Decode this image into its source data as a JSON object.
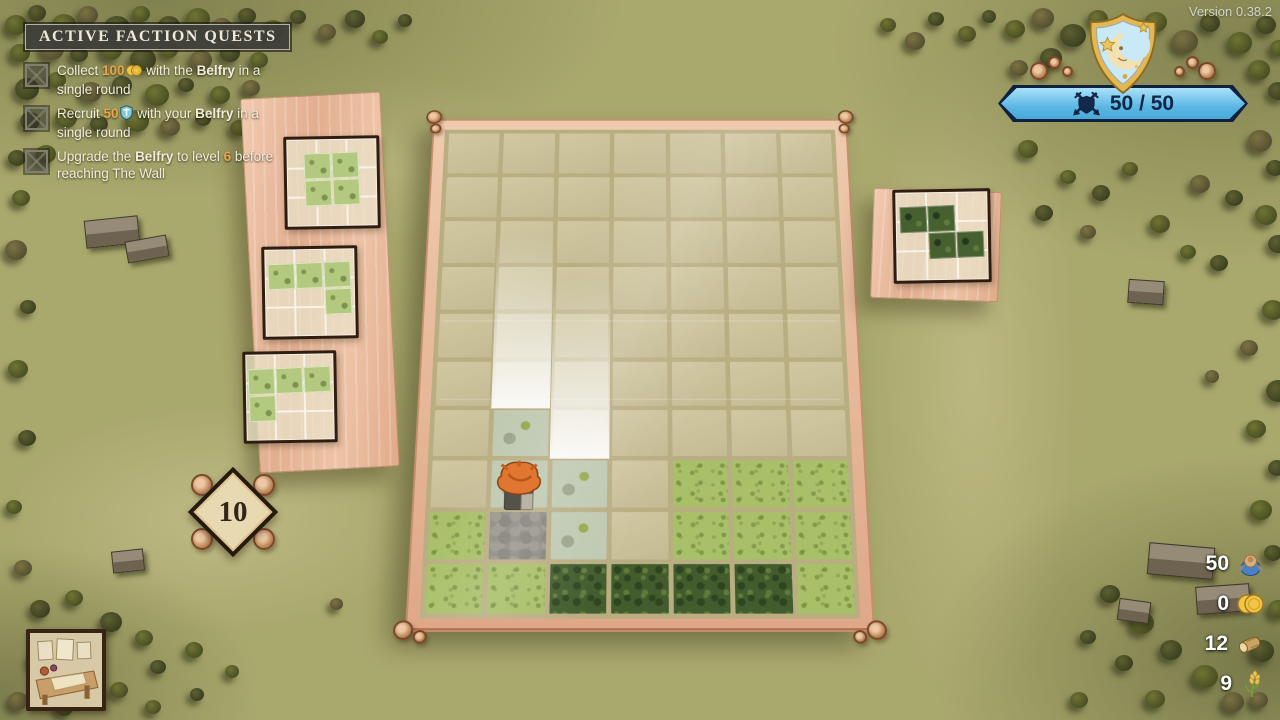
{
  "version_label": "Version 0.38.2",
  "quest_panel": {
    "title": "ACTIVE FACTION QUESTS",
    "quests": [
      {
        "segments": [
          {
            "t": "Collect "
          },
          {
            "t": "100",
            "s": "num"
          },
          {
            "icon": "coins-icon"
          },
          {
            "t": " with the "
          },
          {
            "t": "Belfry",
            "s": "bold"
          },
          {
            "t": " in a single round"
          }
        ]
      },
      {
        "segments": [
          {
            "t": "Recruit "
          },
          {
            "t": "50",
            "s": "num"
          },
          {
            "icon": "recruit-icon"
          },
          {
            "t": " with your "
          },
          {
            "t": "Belfry",
            "s": "bold"
          },
          {
            "t": " in a single round"
          }
        ]
      },
      {
        "segments": [
          {
            "t": "Upgrade the "
          },
          {
            "t": "Belfry",
            "s": "bold"
          },
          {
            "t": " to level "
          },
          {
            "t": "6",
            "s": "num"
          },
          {
            "t": " before reaching The Wall"
          }
        ]
      }
    ]
  },
  "round_counter": {
    "value": "10"
  },
  "hp_banner": {
    "value": "50 / 50",
    "icon": "shield-swords-icon"
  },
  "faction_emblem": "moon-shield-icon",
  "resources": [
    {
      "name": "villagers",
      "value": "50"
    },
    {
      "name": "coins",
      "value": "0"
    },
    {
      "name": "wood",
      "value": "12"
    },
    {
      "name": "wheat",
      "value": "9"
    }
  ],
  "board": {
    "cols": 7,
    "rows": 10,
    "legend": {
      ".": "empty",
      "P": "sparse-grass",
      "G": "grass",
      "F": "forest",
      "S": "stone-camp"
    },
    "map": [
      ".......",
      ".......",
      ".......",
      ".......",
      ".......",
      ".......",
      ".P.....",
      ".PP.GGG",
      "GSP.GGG",
      "GGFFFFG"
    ]
  },
  "piece_queue": {
    "left": [
      {
        "type": "grass",
        "shape": [
          [
            1,
            1
          ],
          [
            1,
            1
          ]
        ]
      },
      {
        "type": "grass",
        "shape": [
          [
            1,
            1,
            1
          ],
          [
            0,
            0,
            1
          ]
        ]
      },
      {
        "type": "grass",
        "shape": [
          [
            1,
            1,
            1
          ],
          [
            1,
            0,
            0
          ]
        ]
      }
    ],
    "right": [
      {
        "type": "forest",
        "shape": [
          [
            1,
            1,
            0
          ],
          [
            0,
            1,
            1
          ]
        ]
      }
    ]
  },
  "colors": {
    "accent_gold": "#e8a845",
    "banner_blue": "#5ab6e4",
    "banner_border": "#10213f",
    "field_green": "#a9a86d",
    "frame_wood": "#e2ae8f"
  }
}
